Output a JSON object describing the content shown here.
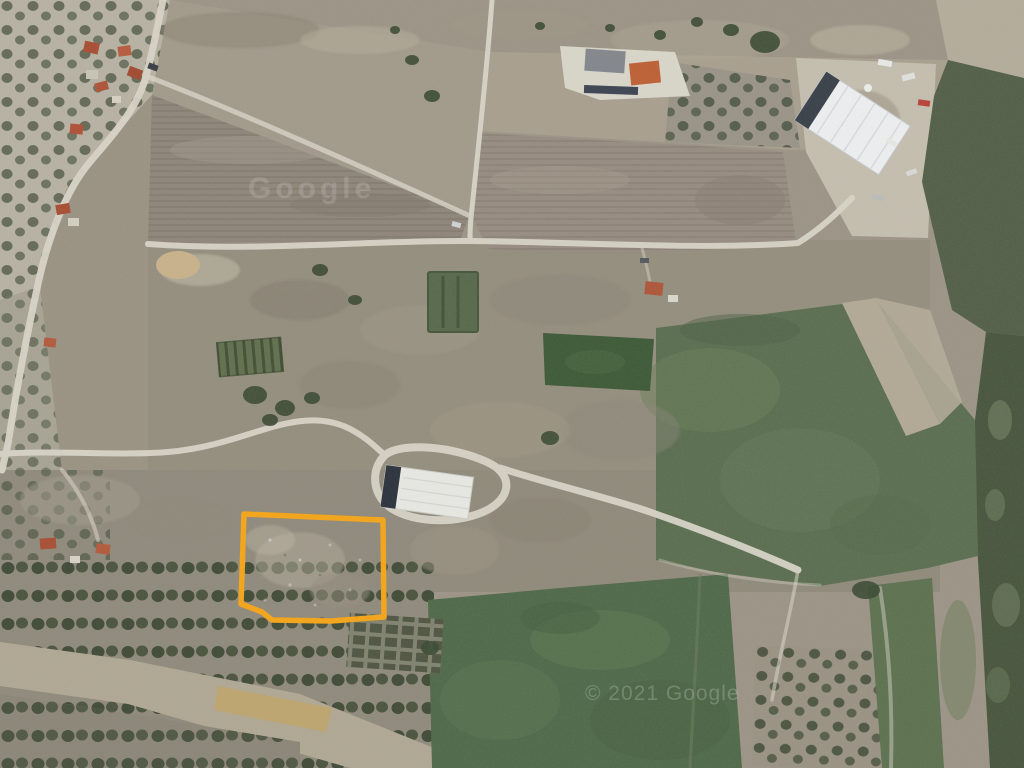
{
  "watermarks": {
    "center": "Google",
    "bottom_right": "© 2021 Google"
  },
  "parcel_overlay": {
    "stroke_color": "#F2A51E",
    "points": "244,514 383,520 384,617 331,621 272,620 262,612 241,604"
  }
}
